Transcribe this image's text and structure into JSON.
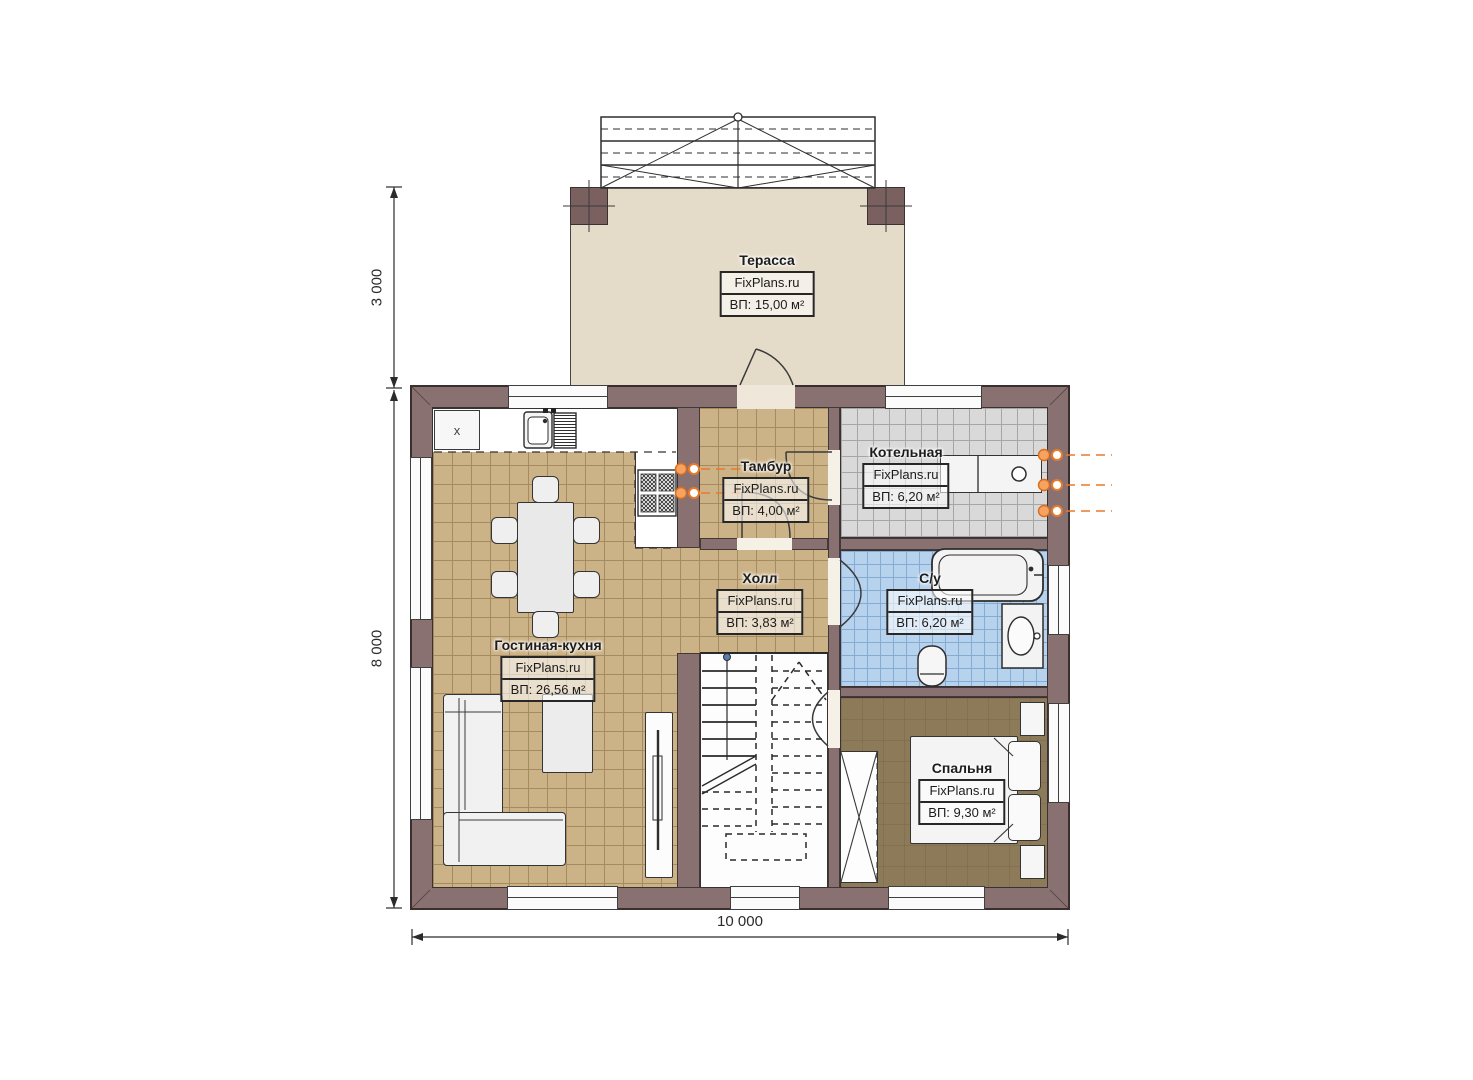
{
  "watermark": "FixPlans.ru",
  "rooms": [
    {
      "id": "terrace",
      "name": "Терасса",
      "area": "ВП: 15,00 м²"
    },
    {
      "id": "tambour",
      "name": "Тамбур",
      "area": "ВП: 4,00 м²"
    },
    {
      "id": "boiler",
      "name": "Котельная",
      "area": "ВП: 6,20 м²"
    },
    {
      "id": "hall",
      "name": "Холл",
      "area": "ВП: 3,83 м²"
    },
    {
      "id": "bathroom",
      "name": "С/у",
      "area": "ВП: 6,20 м²"
    },
    {
      "id": "living_kitchen",
      "name": "Гостиная-кухня",
      "area": "ВП: 26,56 м²"
    },
    {
      "id": "bedroom",
      "name": "Спальня",
      "area": "ВП: 9,30 м²"
    }
  ],
  "dimensions": {
    "terrace_depth": "3 000",
    "house_depth": "8 000",
    "house_width": "10 000"
  },
  "kitchen": {
    "corner_unit_label": "х"
  },
  "colors": {
    "wall": "#8a7171",
    "terrace_floor": "#e5dbc9",
    "tile_tan": "#ccb287",
    "tile_gray": "#d9d9d9",
    "tile_blue": "#b7d2ed",
    "bedroom_floor": "#8d7a58",
    "pipe_orange": "#e87a2c",
    "outline": "#3a3232"
  }
}
